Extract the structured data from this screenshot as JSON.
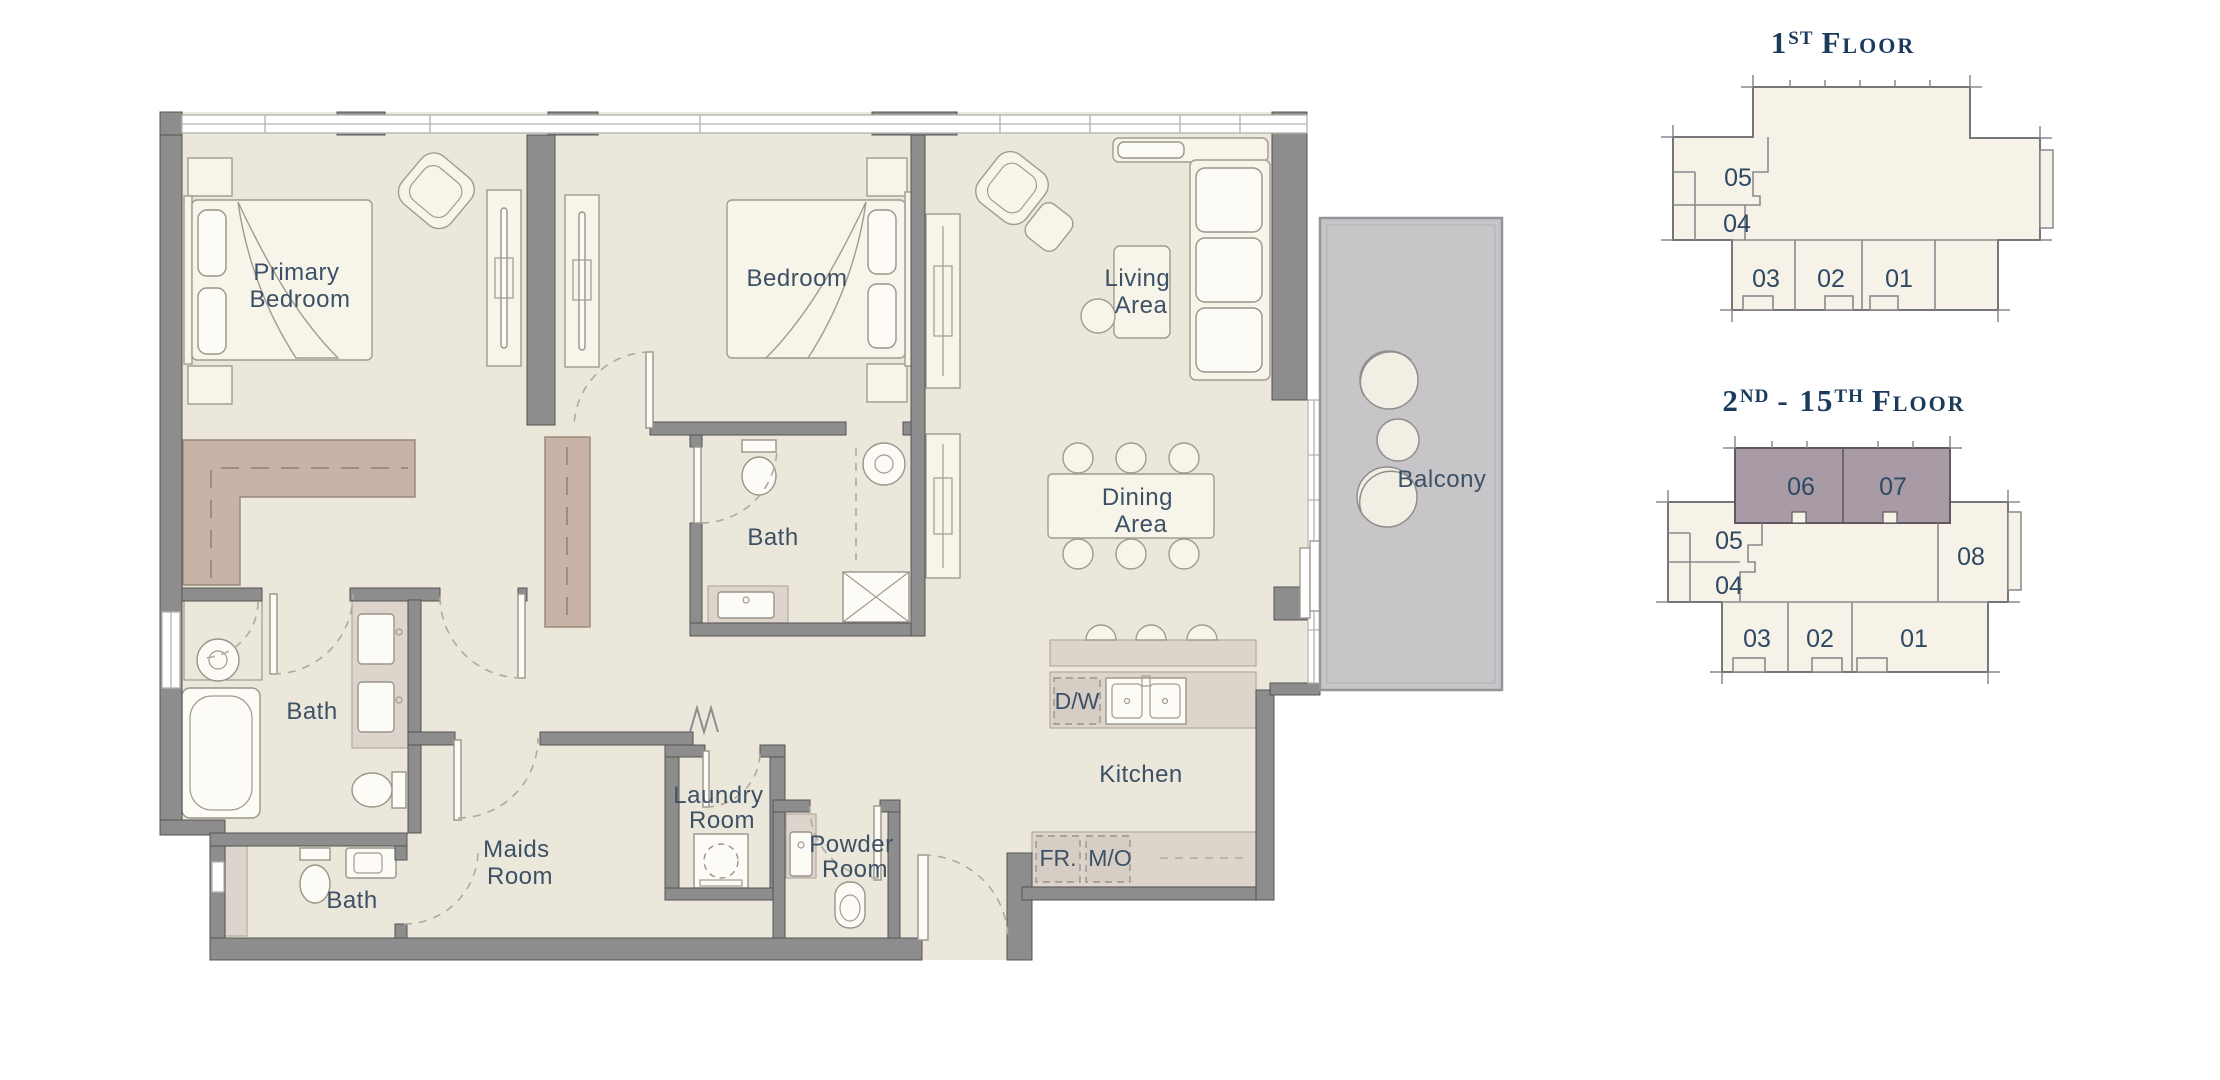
{
  "document": {
    "type": "apartment floor plan sheet",
    "colors": {
      "floor": "#ebe7da",
      "wall": "#8d8d8d",
      "balcony_floor": "#c7c5c8",
      "built_in_wardrobe": "#c9b3a7",
      "counter": "#ddd5cc",
      "keyplan_fill": "#f6f2e7",
      "keyplan_highlight": "#a89ba5",
      "room_label": "#3d5166",
      "title": "#1b3a5c"
    }
  },
  "main_plan": {
    "rooms": {
      "primary_bedroom": {
        "line1": "Primary",
        "line2": "Bedroom"
      },
      "bedroom": {
        "label": "Bedroom"
      },
      "living_area": {
        "line1": "Living",
        "line2": "Area"
      },
      "dining_area": {
        "line1": "Dining",
        "line2": "Area"
      },
      "balcony": {
        "label": "Balcony"
      },
      "bath_primary": {
        "label": "Bath"
      },
      "bath_shared": {
        "label": "Bath"
      },
      "bath_maids": {
        "label": "Bath"
      },
      "maids_room": {
        "line1": "Maids",
        "line2": "Room"
      },
      "laundry_room": {
        "line1": "Laundry",
        "line2": "Room"
      },
      "powder_room": {
        "line1": "Powder",
        "line2": "Room"
      },
      "kitchen": {
        "label": "Kitchen"
      }
    },
    "appliances": {
      "dishwasher": "D/W",
      "fridge": "FR.",
      "microwave_oven": "M/O"
    }
  },
  "key_plans": {
    "first_floor": {
      "title": {
        "num": "1",
        "sup": "ST",
        "rest": "Floor"
      },
      "units": {
        "u05": "05",
        "u04": "04",
        "u03": "03",
        "u02": "02",
        "u01": "01"
      }
    },
    "upper_floors": {
      "title": {
        "p1": "2",
        "s1": "ND",
        "p2": "- 15",
        "s2": "TH",
        "rest": "Floor"
      },
      "units": {
        "u06": "06",
        "u07": "07",
        "u05": "05",
        "u04": "04",
        "u08": "08",
        "u03": "03",
        "u02": "02",
        "u01": "01"
      },
      "highlighted_units": [
        "06",
        "07"
      ]
    }
  }
}
